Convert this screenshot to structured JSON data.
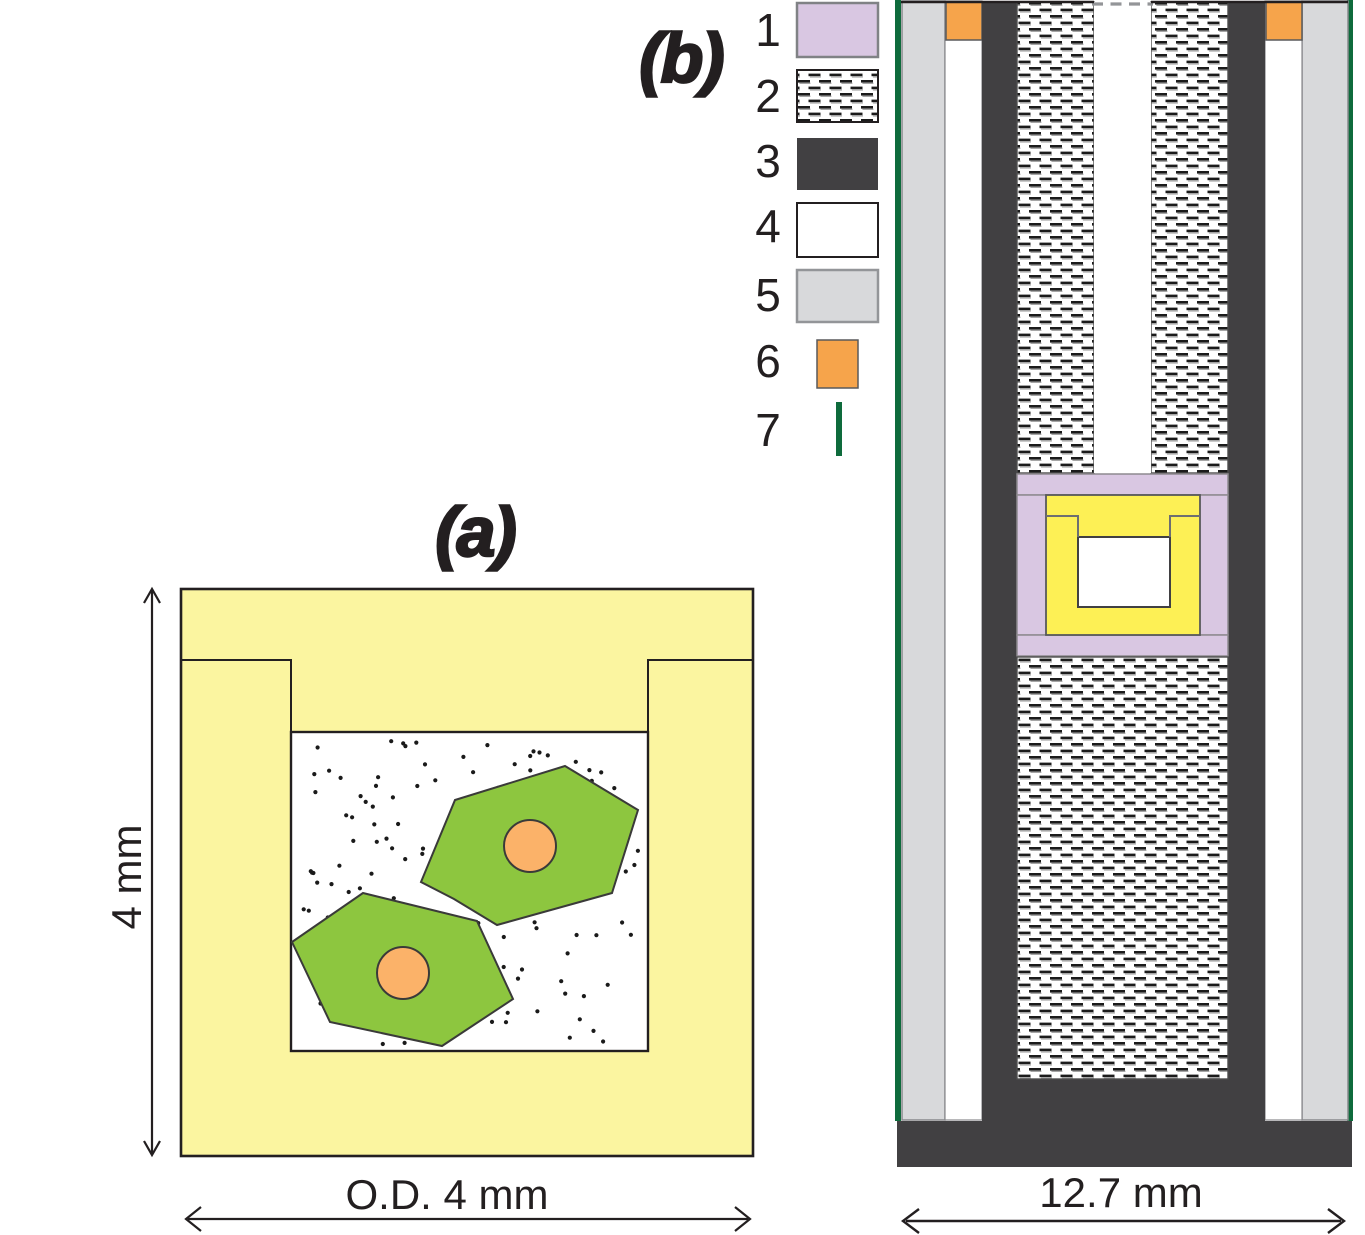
{
  "panel_a": {
    "title": "(a)",
    "height_label": "4 mm",
    "width_label": "O.D. 4 mm",
    "description": "crucible cross-section with flux, two crystals and seed cores"
  },
  "panel_b": {
    "title": "(b)",
    "width_label": "12.7 mm",
    "description": "vertical cross-section of growth assembly"
  },
  "legend": {
    "items": [
      {
        "label": "1",
        "swatch": "lavender-solid"
      },
      {
        "label": "2",
        "swatch": "white-dashed-pattern"
      },
      {
        "label": "3",
        "swatch": "dark-gray-solid"
      },
      {
        "label": "4",
        "swatch": "white-solid"
      },
      {
        "label": "5",
        "swatch": "light-gray-solid"
      },
      {
        "label": "6",
        "swatch": "orange-solid"
      },
      {
        "label": "7",
        "swatch": "green-line"
      }
    ]
  },
  "colors": {
    "crucible_yellow_a": "#FBF5A0",
    "crucible_yellow_b": "#FDF055",
    "crystal_green": "#8DC63F",
    "seed_orange": "#FBB269",
    "orange_square": "#F6A44B",
    "lavender": "#D9C7E2",
    "dark_gray": "#414042",
    "light_gray": "#D8D9DB",
    "green_line": "#0E6B3C",
    "outline_black": "#231F20",
    "seam_gray": "#6D6E71",
    "border_gray": "#88898C",
    "dot_black": "#1A1A1A"
  }
}
